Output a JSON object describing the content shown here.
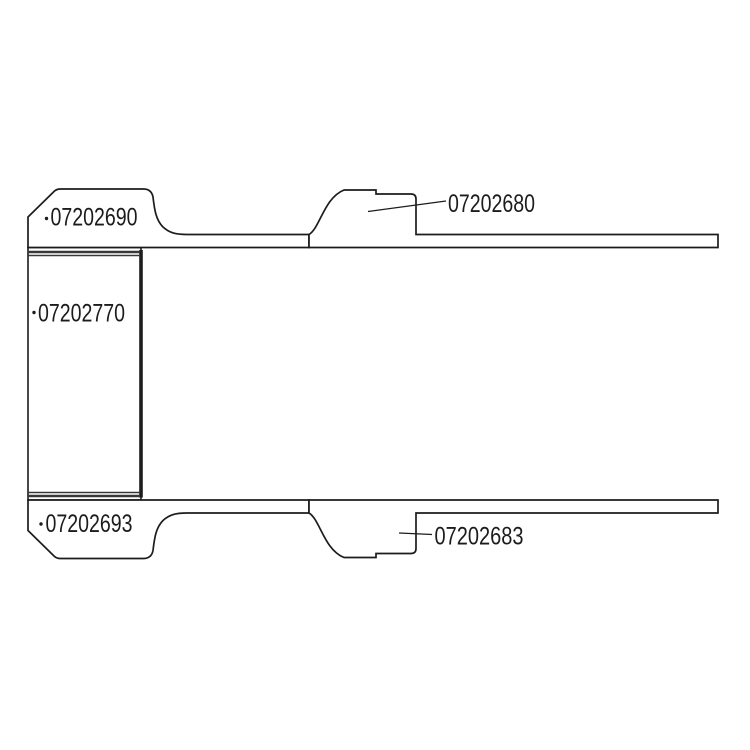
{
  "diagram": {
    "type": "technical-cross-section-drawing",
    "background_color": "#ffffff",
    "line_color": "#1c1c1c",
    "crimp_band_color": "#383838",
    "parts": {
      "top_left_fitting": "07202690",
      "top_right_nipple": "07202680",
      "sleeve": "07202770",
      "bottom_left_fitting": "07202693",
      "bottom_right_nipple": "07202683"
    }
  }
}
